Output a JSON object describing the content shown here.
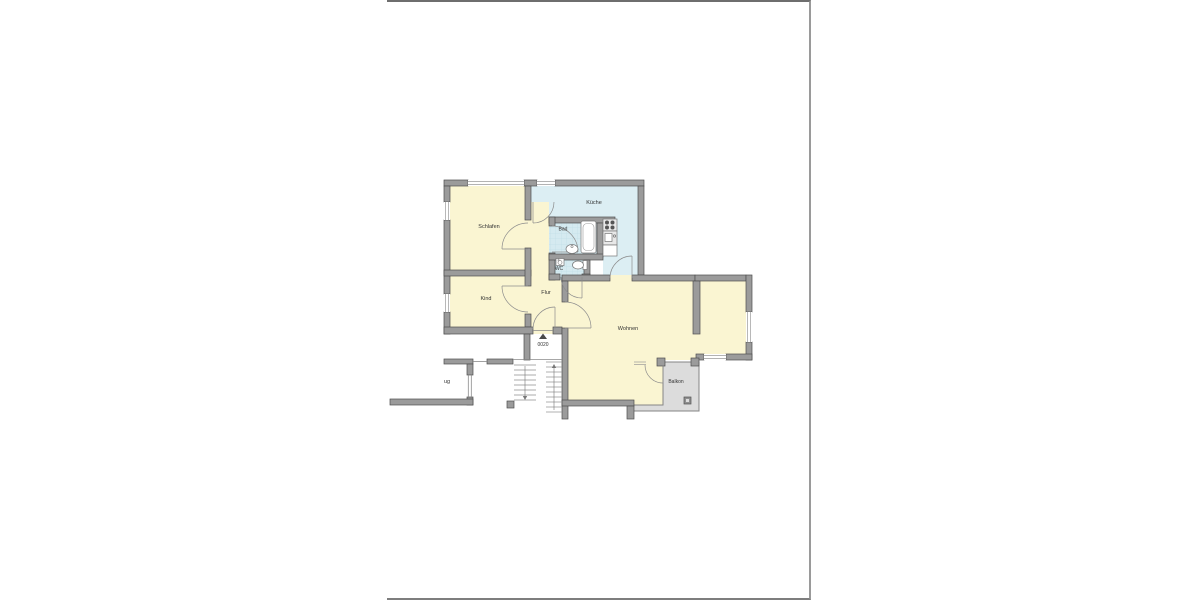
{
  "floorplan": {
    "labels": {
      "schlafen": "Schlafen",
      "kind": "Kind",
      "kueche": "Küche",
      "bad": "Bad",
      "wc": "WC",
      "flur": "Flur",
      "wohnen": "Wohnen",
      "balkon": "Balkon",
      "aufzug": "ug",
      "unit": "0020"
    },
    "colors": {
      "room_yellow": "#FAF5D2",
      "wet_blue": "#DCEEF3",
      "tile_blue": "#D5EAF0",
      "balcony_gray": "#DCDCDC",
      "wall_gray": "#9b9b9b"
    }
  }
}
